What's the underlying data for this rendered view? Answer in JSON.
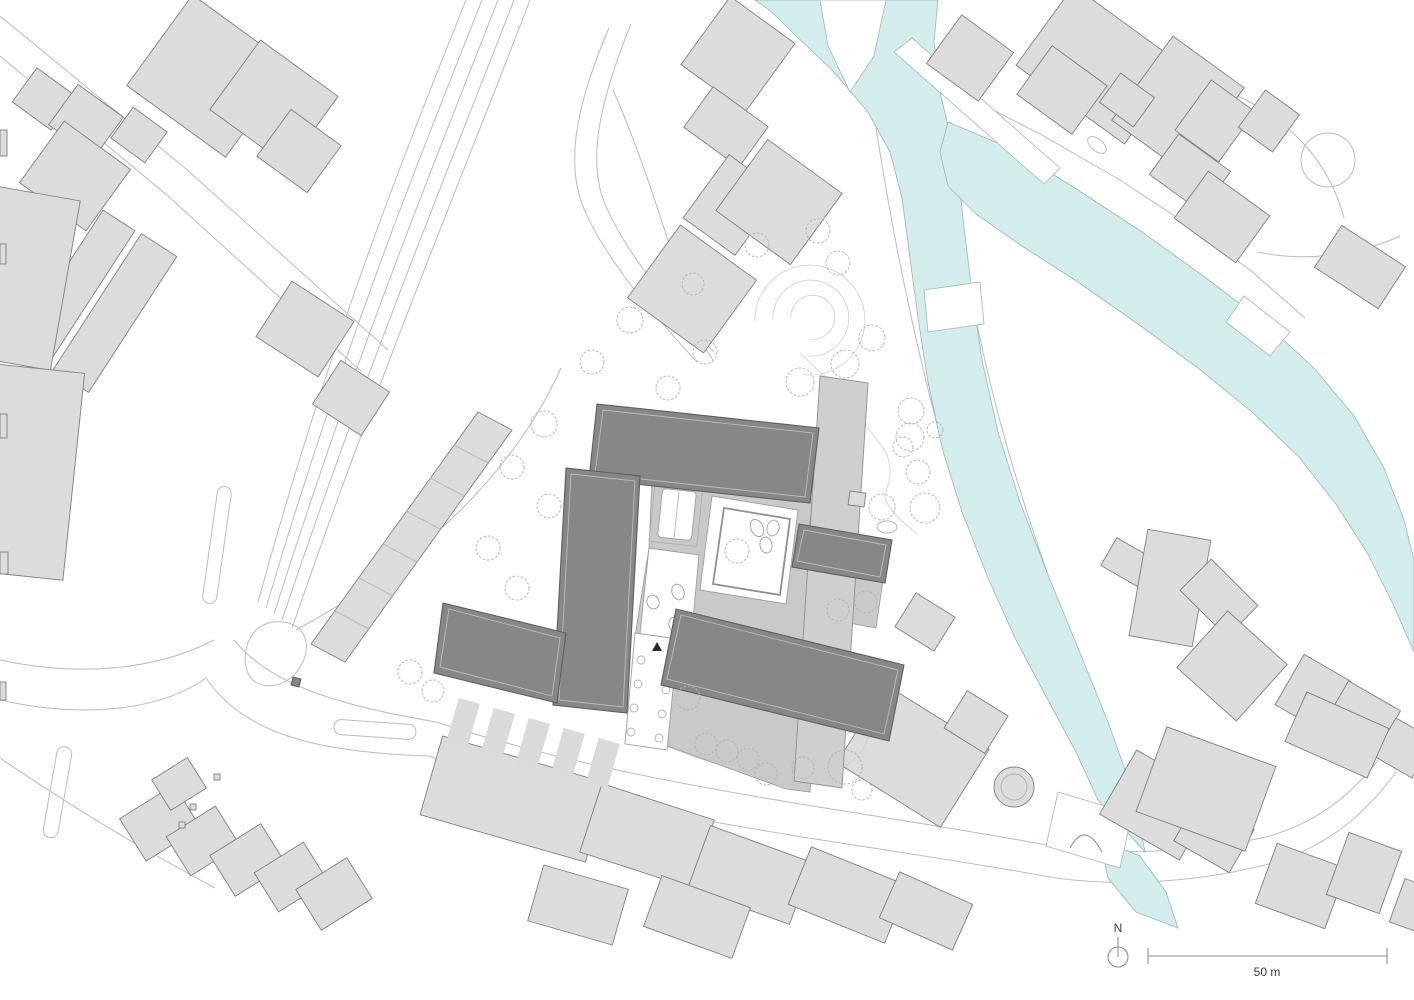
{
  "plan": {
    "annotations": {
      "north_label": "N",
      "scale_label": "50 m"
    },
    "colors": {
      "background": "#ffffff",
      "water": "#d3ecec",
      "water_edge": "#9ab6b5",
      "context_fill": "#dcdcdc",
      "context_stroke": "#7f7f7f",
      "project_dark": "#878787",
      "project_dark_stroke": "#5e5e5e",
      "podium": "#c9c9c9",
      "podium_stroke": "#9a9a9a",
      "bar": "#cfcfcf",
      "street": "#bbbbbb",
      "vegetation": "#b5b5b5",
      "text": "#3a3a3a"
    }
  }
}
